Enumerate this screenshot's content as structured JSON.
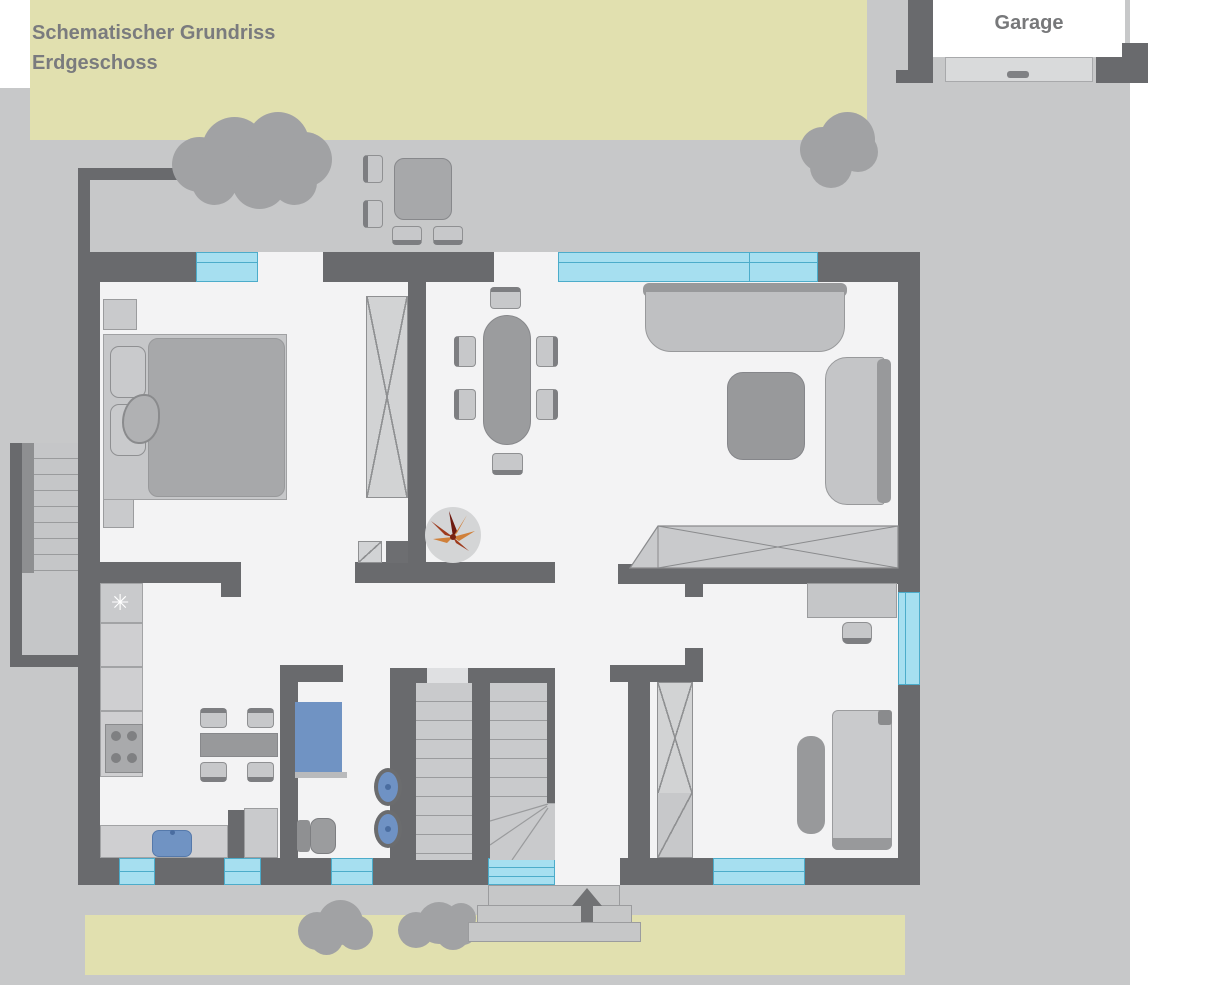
{
  "title": {
    "line1": "Schematischer Grundriss",
    "line2": "Erdgeschoss"
  },
  "garage": {
    "label": "Garage"
  },
  "icons": {
    "fridge_snowflake": "✳",
    "entrance_arrow": "up-arrow-icon",
    "plant": "plant-icon"
  },
  "palette": {
    "garden_green": "#e1e0af",
    "ground_gray": "#c7c8c9",
    "wall_dark": "#696a6d",
    "floor_white": "#f3f3f4",
    "window_fill": "#a6dff0",
    "window_border": "#4cacca",
    "furniture_light": "#c9cacc",
    "furniture_mid": "#9b9c9e",
    "fixture_blue": "#7093c3",
    "plant_orange": "#d0803a",
    "plant_red": "#9e3a1c",
    "text_gray": "#7a7b7e"
  },
  "furniture": {
    "bedroom": [
      "double-bed",
      "pillows",
      "nightstands",
      "wardrobe"
    ],
    "dining_area": [
      "oval-table",
      "six-chairs",
      "plant"
    ],
    "living_area": [
      "sofa",
      "armchair",
      "coffee-table",
      "sideboard"
    ],
    "kitchen": [
      "fridge",
      "counters",
      "stove",
      "sink",
      "table",
      "four-chairs",
      "cabinet"
    ],
    "bathroom": [
      "shower",
      "toilet",
      "two-washbasins"
    ],
    "study_room": [
      "desk",
      "chair",
      "wardrobe",
      "bed",
      "rug"
    ],
    "terrace": [
      "garden-table",
      "four-chairs",
      "trees"
    ],
    "outdoor": [
      "entrance-steps",
      "basement-stairs",
      "driveway",
      "garage-door"
    ]
  }
}
